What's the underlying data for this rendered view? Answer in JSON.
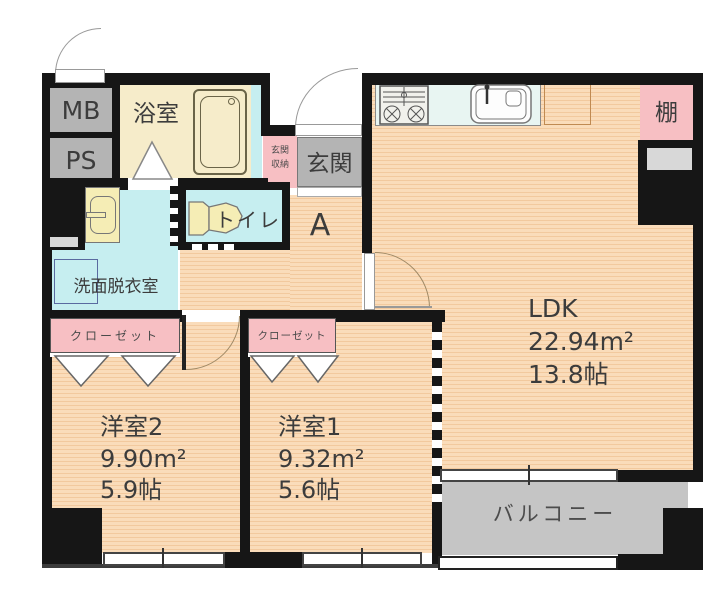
{
  "plan_title": "2LDK apartment floor plan",
  "rooms": {
    "ldk": {
      "name": "LDK",
      "area_sqm": "22.94m²",
      "area_tatami": "13.8帖"
    },
    "bedroom2": {
      "name": "洋室2",
      "area_sqm": "9.90m²",
      "area_tatami": "5.9帖"
    },
    "bedroom1": {
      "name": "洋室1",
      "area_sqm": "9.32m²",
      "area_tatami": "5.6帖"
    },
    "bathroom": {
      "name": "浴室"
    },
    "toilet": {
      "name": "トイレ"
    },
    "washroom": {
      "name": "洗面脱衣室"
    },
    "entrance": {
      "name": "玄関"
    },
    "entrance_storage": {
      "line1": "玄関",
      "line2": "収納"
    },
    "hallway": {
      "name": "A"
    },
    "balcony": {
      "name": "バルコニー"
    },
    "shelf": {
      "name": "棚"
    },
    "meter_box": {
      "name": "MB"
    },
    "pipe_space": {
      "name": "PS"
    },
    "closet_left": {
      "name": "クローゼット"
    },
    "closet_right": {
      "name": "クローゼット"
    }
  },
  "colors": {
    "floor_stripe_light": "#fadcba",
    "floor_stripe_dark": "#f2c99e",
    "wet_area_cyan": "#c6eef0",
    "bathroom_cream": "#f6ecca",
    "accent_pink": "#f7bfc3",
    "unit_gray": "#b4b4b4",
    "balcony_gray": "#c5c5c5",
    "wall_black": "#161616"
  }
}
